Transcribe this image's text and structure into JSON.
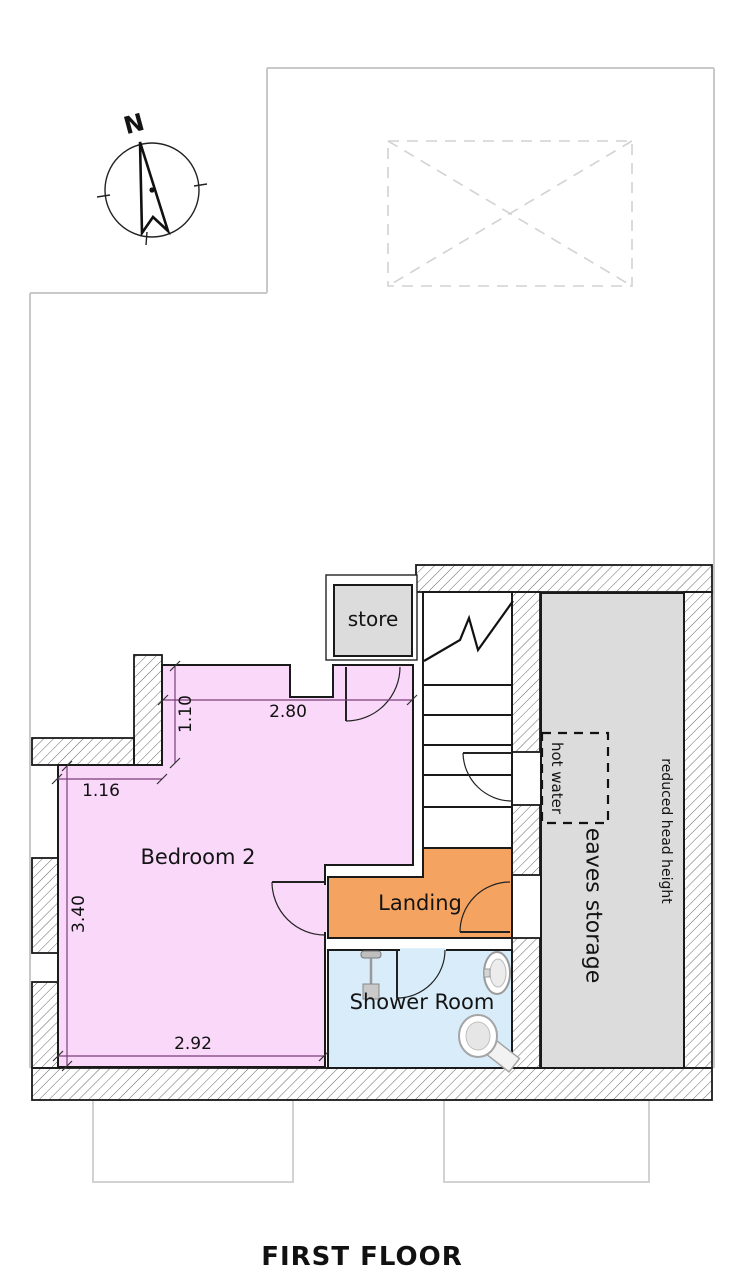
{
  "plan": {
    "title": "FIRST FLOOR",
    "compass_north": "N",
    "rooms": {
      "store": {
        "label": "store",
        "fill": "#dcdcdc"
      },
      "bedroom2": {
        "label": "Bedroom 2",
        "fill": "#f9d8f9"
      },
      "landing": {
        "label": "Landing",
        "fill": "#f4a360"
      },
      "shower_room": {
        "label": "Shower Room",
        "fill": "#d8ecfa"
      },
      "eaves_storage": {
        "label": "eaves storage",
        "fill": "#dcdcdc"
      }
    },
    "labels": {
      "hot_water": "hot water",
      "reduced_head_height": "reduced head height"
    },
    "dimensions": {
      "bedroom_top_width": "2.80",
      "bedroom_top_depth": "1.10",
      "bedroom_left_width": "1.16",
      "bedroom_left_depth": "3.40",
      "bedroom_bottom_width": "2.92"
    }
  }
}
